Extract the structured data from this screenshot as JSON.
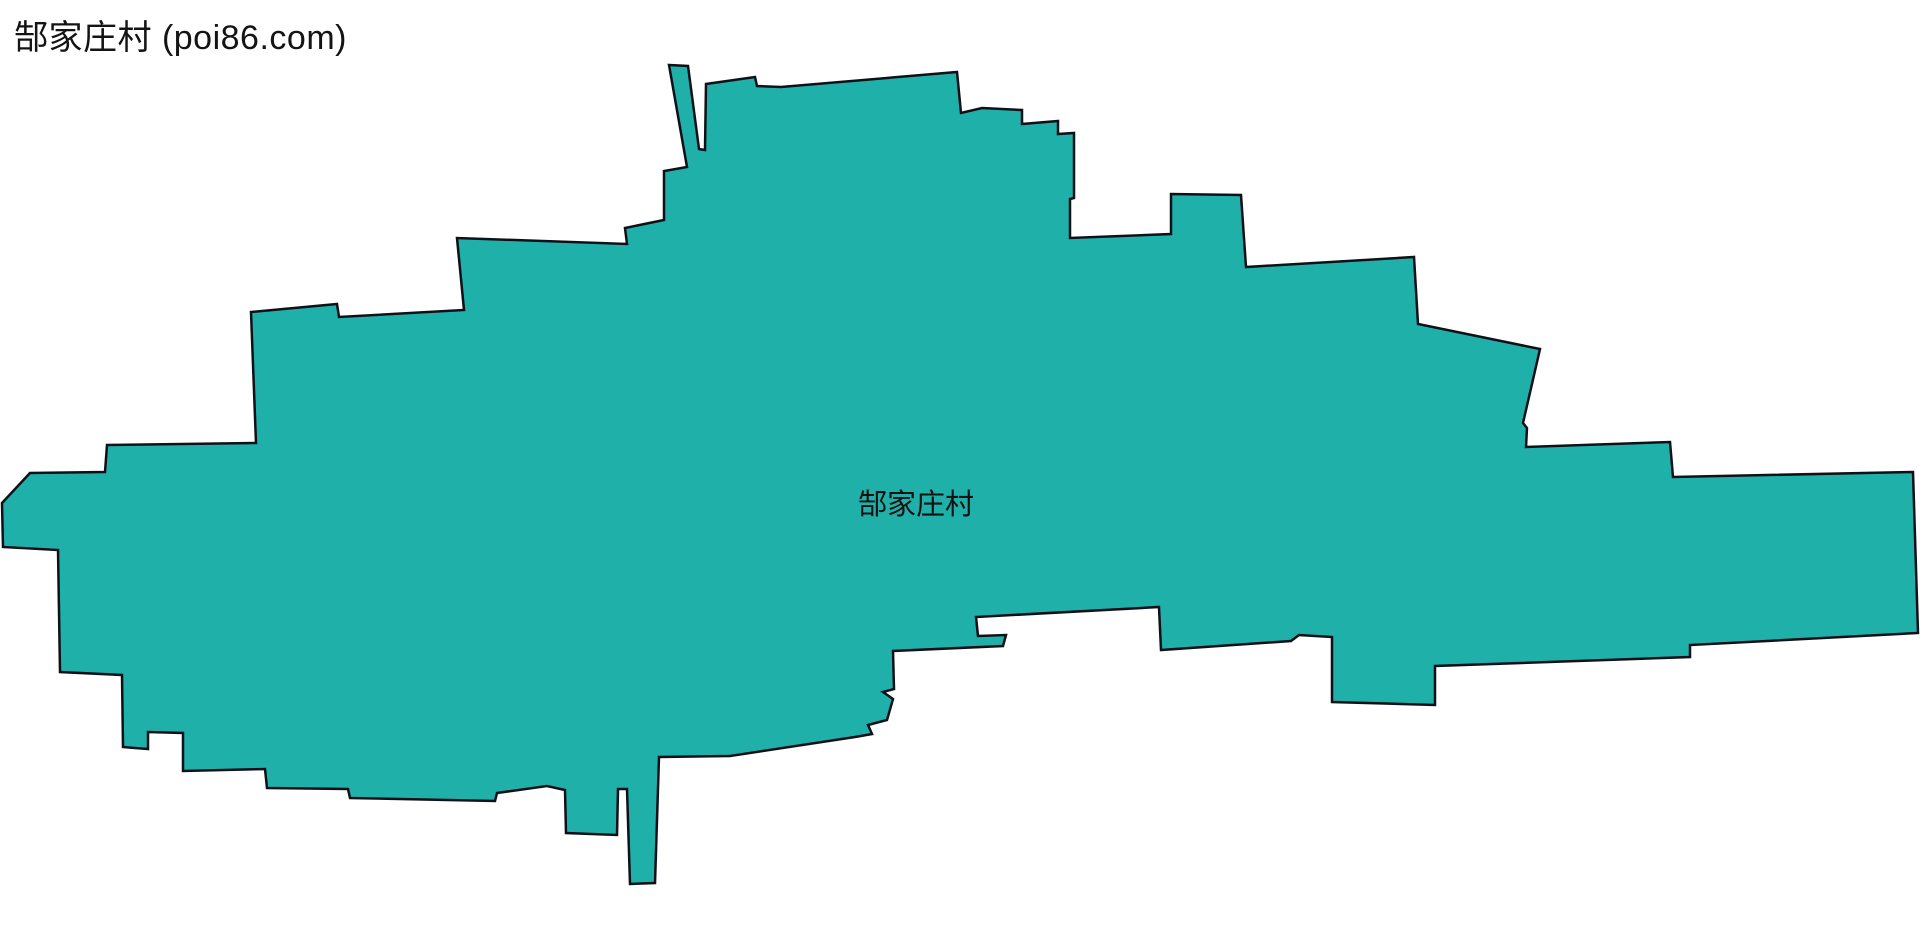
{
  "header": {
    "title": "郜家庄村 (poi86.com)"
  },
  "map": {
    "label": "郜家庄村",
    "label_x": 916,
    "label_y": 514,
    "label_color": "#111111",
    "fill_color": "#1fb1a9",
    "stroke_color": "#101018",
    "stroke_width": 2.5,
    "background_color": "#ffffff",
    "canvas_width": 1920,
    "canvas_height": 951,
    "polygon_points": [
      [
        669,
        65
      ],
      [
        688,
        66
      ],
      [
        699,
        149
      ],
      [
        705,
        150
      ],
      [
        706,
        84
      ],
      [
        755,
        77
      ],
      [
        757,
        86
      ],
      [
        781,
        87
      ],
      [
        957,
        72
      ],
      [
        961,
        113
      ],
      [
        982,
        108
      ],
      [
        1022,
        110
      ],
      [
        1022,
        124
      ],
      [
        1058,
        121
      ],
      [
        1058,
        134
      ],
      [
        1074,
        133
      ],
      [
        1074,
        198
      ],
      [
        1070,
        199
      ],
      [
        1070,
        238
      ],
      [
        1171,
        234
      ],
      [
        1171,
        194
      ],
      [
        1241,
        195
      ],
      [
        1246,
        267
      ],
      [
        1414,
        257
      ],
      [
        1418,
        324
      ],
      [
        1540,
        349
      ],
      [
        1523,
        423
      ],
      [
        1527,
        428
      ],
      [
        1526,
        447
      ],
      [
        1670,
        442
      ],
      [
        1673,
        477
      ],
      [
        1913,
        472
      ],
      [
        1918,
        633
      ],
      [
        1690,
        645
      ],
      [
        1690,
        657
      ],
      [
        1435,
        666
      ],
      [
        1435,
        705
      ],
      [
        1332,
        702
      ],
      [
        1332,
        637
      ],
      [
        1299,
        635
      ],
      [
        1291,
        641
      ],
      [
        1161,
        650
      ],
      [
        1159,
        607
      ],
      [
        976,
        617
      ],
      [
        978,
        636
      ],
      [
        1006,
        635
      ],
      [
        1003,
        646
      ],
      [
        893,
        651
      ],
      [
        894,
        689
      ],
      [
        883,
        692
      ],
      [
        893,
        699
      ],
      [
        887,
        720
      ],
      [
        868,
        725
      ],
      [
        872,
        734
      ],
      [
        855,
        737
      ],
      [
        730,
        756
      ],
      [
        659,
        757
      ],
      [
        655,
        883
      ],
      [
        630,
        884
      ],
      [
        627,
        789
      ],
      [
        618,
        789
      ],
      [
        617,
        835
      ],
      [
        566,
        833
      ],
      [
        565,
        790
      ],
      [
        547,
        786
      ],
      [
        497,
        793
      ],
      [
        495,
        801
      ],
      [
        350,
        798
      ],
      [
        348,
        789
      ],
      [
        267,
        788
      ],
      [
        265,
        769
      ],
      [
        183,
        771
      ],
      [
        183,
        733
      ],
      [
        148,
        732
      ],
      [
        148,
        749
      ],
      [
        123,
        747
      ],
      [
        122,
        675
      ],
      [
        60,
        672
      ],
      [
        58,
        550
      ],
      [
        3,
        547
      ],
      [
        2,
        503
      ],
      [
        30,
        473
      ],
      [
        105,
        472
      ],
      [
        107,
        445
      ],
      [
        256,
        443
      ],
      [
        251,
        312
      ],
      [
        337,
        304
      ],
      [
        339,
        317
      ],
      [
        464,
        310
      ],
      [
        457,
        238
      ],
      [
        627,
        244
      ],
      [
        625,
        228
      ],
      [
        664,
        220
      ],
      [
        664,
        171
      ],
      [
        687,
        167
      ]
    ]
  },
  "watermark": {
    "text": "poi86.com",
    "angle_deg": -45,
    "tile_width": 200,
    "tile_height": 196,
    "offset_x": 0,
    "offset_y": 92,
    "font_size": 30,
    "opacity": 0.07,
    "color": "#000000"
  }
}
